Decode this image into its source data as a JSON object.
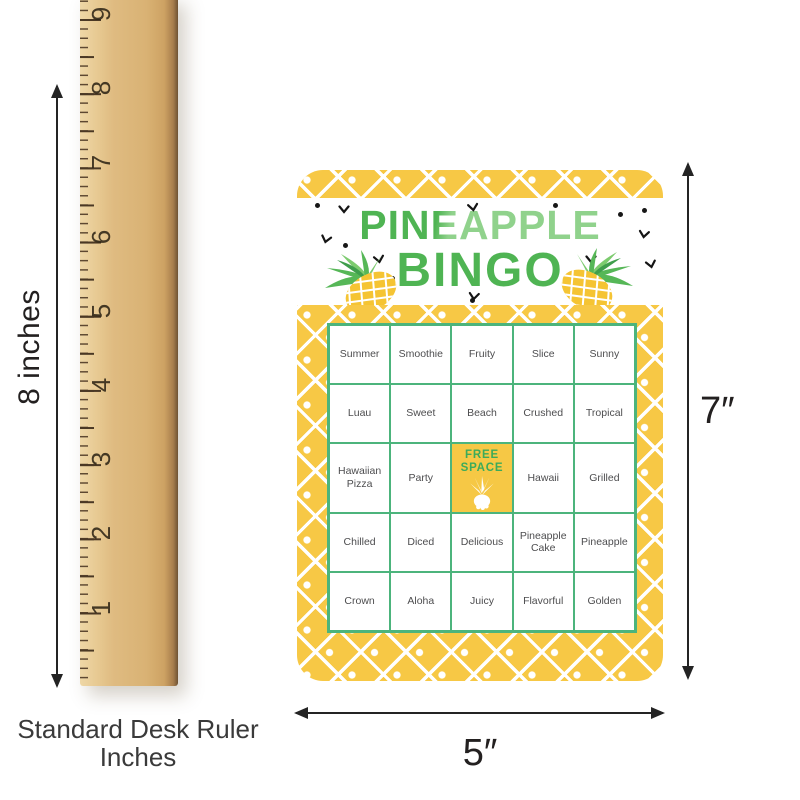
{
  "ruler": {
    "numbers": [
      "9",
      "8",
      "7",
      "6",
      "5",
      "4",
      "3",
      "2",
      "1"
    ],
    "caption": {
      "line1": "Standard Desk Ruler",
      "line2": "Inches"
    }
  },
  "dimensions": {
    "ruler_height_label": "8 inches",
    "card_height_label": "7″",
    "card_width_label": "5″"
  },
  "card": {
    "title_line1": "PINEAPPLE",
    "title_line2": "BINGO",
    "free_space": {
      "line1": "FREE",
      "line2": "SPACE"
    },
    "grid": [
      [
        "Summer",
        "Smoothie",
        "Fruity",
        "Slice",
        "Sunny"
      ],
      [
        "Luau",
        "Sweet",
        "Beach",
        "Crushed",
        "Tropical"
      ],
      [
        "Hawaiian Pizza",
        "Party",
        "FREE SPACE",
        "Hawaii",
        "Grilled"
      ],
      [
        "Chilled",
        "Diced",
        "Delicious",
        "Pineapple Cake",
        "Pineapple"
      ],
      [
        "Crown",
        "Aloha",
        "Juicy",
        "Flavorful",
        "Golden"
      ]
    ],
    "colors": {
      "pattern_yellow": "#F7C845",
      "title_green_dark": "#4FB453",
      "title_green_light": "#90D28C",
      "grid_line_green": "#4CB47C",
      "free_space_text_green": "#3CAB5A",
      "cell_text": "#4D4D4F"
    }
  }
}
